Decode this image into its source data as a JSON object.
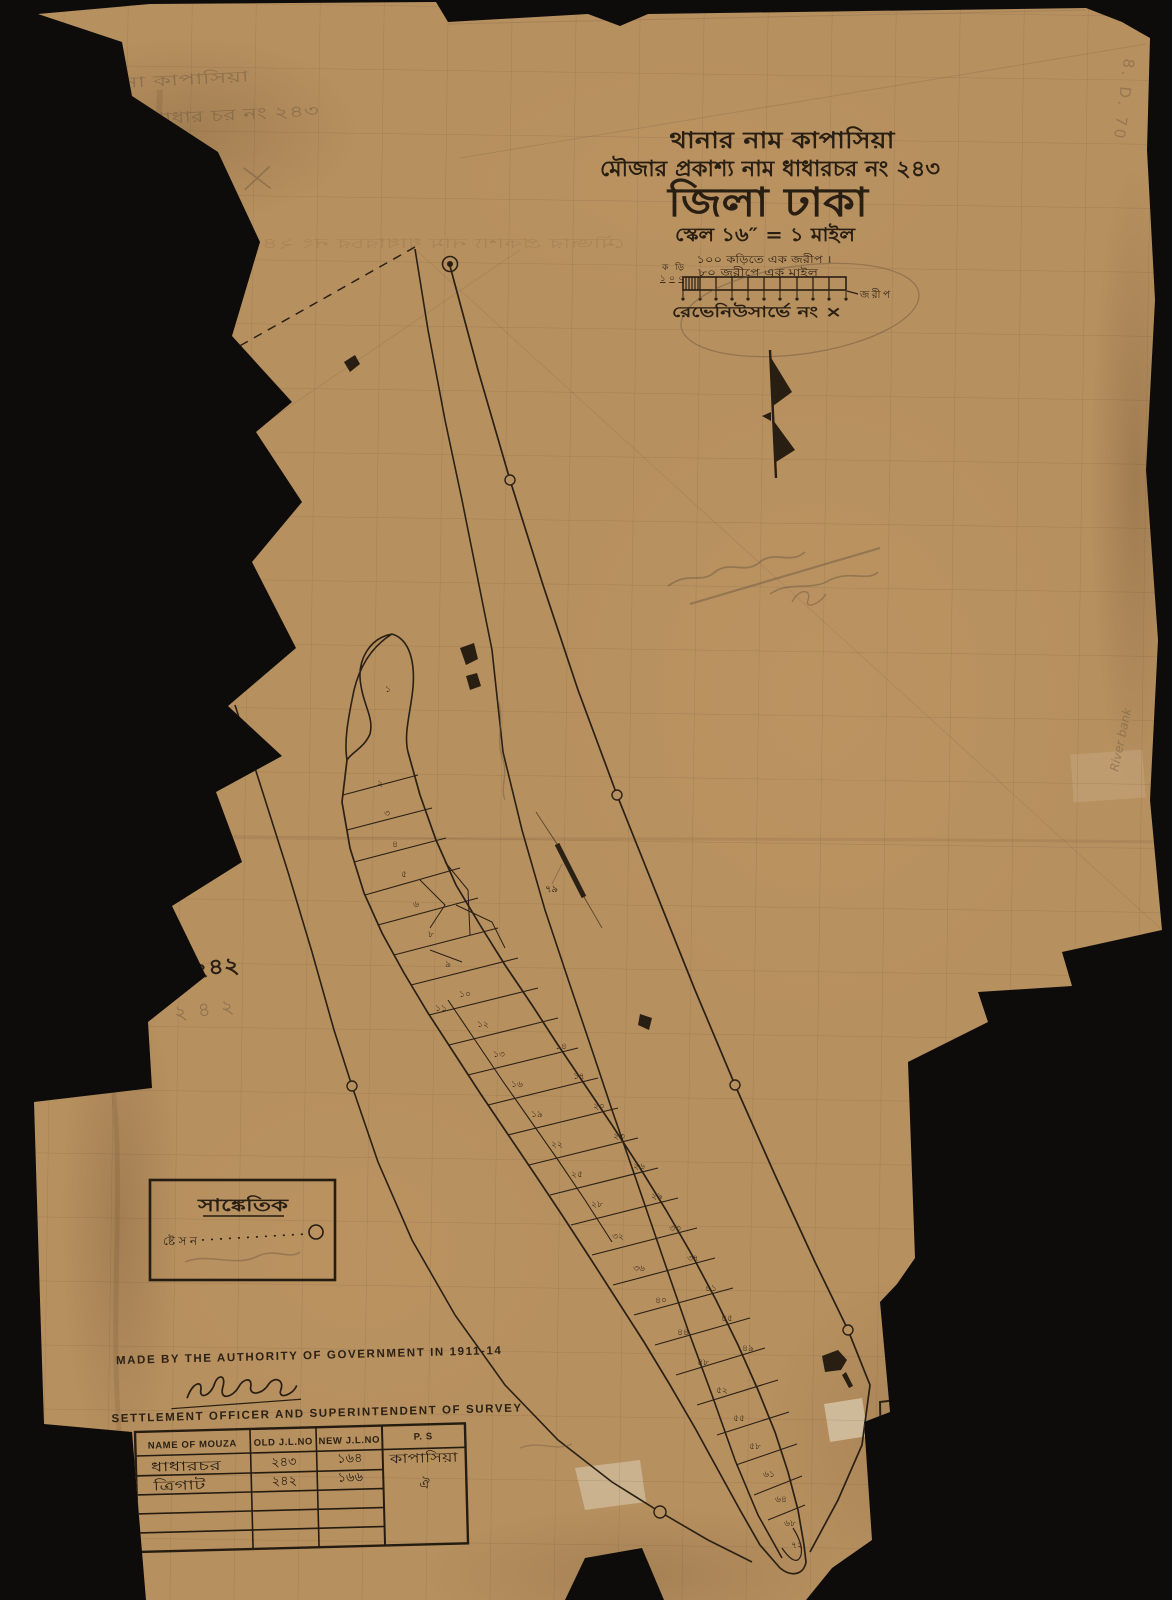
{
  "scan": {
    "background_color": "#0d0c0a",
    "paper_color": "#b7905f",
    "ink_color": "#281e12",
    "pencil_color": "#6f5a42"
  },
  "title": {
    "line1": "থানার নাম কাপাসিয়া",
    "line2": "মৌজার প্রকাশ্য নাম ধাধারচর নং ২৪৩",
    "line3": "জিলা ঢাকা",
    "line4": "স্কেল ১৬″ = ১ মাইল"
  },
  "scale_bar": {
    "top_label": "১০০ কড়িতে এক জরীপ ।",
    "bottom_label": "৮০ জরীপে এক মাইল",
    "left_label_top": "কড়ি",
    "left_label_bottom": "১০০",
    "right_label": "জরীপ"
  },
  "revenue_note": "রেভেনিউসার্ভে নং ×",
  "pencil_notes": {
    "top_left_line1": "থানা কাপাসিয়া",
    "top_left_line2": "মৌজা ধাধার চর নং ২৪৩",
    "top_right_vertical": "8. D. 70",
    "right_edge_vertical": "River bank",
    "adjacent_mouza_ink": "নং ২৪২",
    "adjacent_mouza_pencil": "২৪২"
  },
  "legend": {
    "title": "সাঙ্কেতিক",
    "station_label": "ষ্টেসন"
  },
  "map_labels": {
    "road_number": "৭৯"
  },
  "footer": {
    "authority_line": "MADE BY THE AUTHORITY OF GOVERNMENT IN 1911-14",
    "officer_line": "SETTLEMENT OFFICER AND SUPERINTENDENT OF SURVEY"
  },
  "table": {
    "headers": [
      "NAME OF MOUZA",
      "OLD J.L.NO",
      "NEW J.L.NO",
      "P. S"
    ],
    "rows": [
      [
        "ধাধারচর",
        "২৪৩",
        "১৬৪",
        "কাপাসিয়া"
      ],
      [
        "ত্রিগাট",
        "২৪২",
        "১৬৬",
        "ঐ"
      ]
    ]
  },
  "plot_numbers": [
    {
      "t": "১",
      "x": 388,
      "y": 692
    },
    {
      "t": "২",
      "x": 380,
      "y": 786
    },
    {
      "t": "৩",
      "x": 387,
      "y": 816
    },
    {
      "t": "৪",
      "x": 395,
      "y": 847
    },
    {
      "t": "৫",
      "x": 404,
      "y": 877
    },
    {
      "t": "৬",
      "x": 416,
      "y": 907
    },
    {
      "t": "৮",
      "x": 431,
      "y": 937
    },
    {
      "t": "৯",
      "x": 448,
      "y": 967
    },
    {
      "t": "১০",
      "x": 465,
      "y": 997
    },
    {
      "t": "১১",
      "x": 441,
      "y": 1011
    },
    {
      "t": "১২",
      "x": 483,
      "y": 1027
    },
    {
      "t": "১৩",
      "x": 499,
      "y": 1057
    },
    {
      "t": "১৪",
      "x": 561,
      "y": 1049
    },
    {
      "t": "১৬",
      "x": 517,
      "y": 1087
    },
    {
      "t": "১৭",
      "x": 579,
      "y": 1079
    },
    {
      "t": "১৯",
      "x": 537,
      "y": 1117
    },
    {
      "t": "২০",
      "x": 599,
      "y": 1109
    },
    {
      "t": "২২",
      "x": 557,
      "y": 1147
    },
    {
      "t": "২৩",
      "x": 619,
      "y": 1139
    },
    {
      "t": "২৫",
      "x": 577,
      "y": 1177
    },
    {
      "t": "২৬",
      "x": 639,
      "y": 1169
    },
    {
      "t": "২৮",
      "x": 597,
      "y": 1207
    },
    {
      "t": "২৯",
      "x": 657,
      "y": 1199
    },
    {
      "t": "৩২",
      "x": 618,
      "y": 1239
    },
    {
      "t": "৩৩",
      "x": 675,
      "y": 1231
    },
    {
      "t": "৩৬",
      "x": 639,
      "y": 1271
    },
    {
      "t": "৩৭",
      "x": 693,
      "y": 1261
    },
    {
      "t": "৪০",
      "x": 661,
      "y": 1303
    },
    {
      "t": "৪১",
      "x": 711,
      "y": 1291
    },
    {
      "t": "৪৪",
      "x": 683,
      "y": 1335
    },
    {
      "t": "৪৫",
      "x": 727,
      "y": 1321
    },
    {
      "t": "৪৮",
      "x": 703,
      "y": 1365
    },
    {
      "t": "৪৯",
      "x": 748,
      "y": 1351
    },
    {
      "t": "৫২",
      "x": 722,
      "y": 1393
    },
    {
      "t": "৫৫",
      "x": 739,
      "y": 1421
    },
    {
      "t": "৫৮",
      "x": 755,
      "y": 1449
    },
    {
      "t": "৬১",
      "x": 769,
      "y": 1477
    },
    {
      "t": "৬৪",
      "x": 781,
      "y": 1502
    },
    {
      "t": "৬৮",
      "x": 790,
      "y": 1526
    },
    {
      "t": "৭২",
      "x": 797,
      "y": 1548
    }
  ]
}
